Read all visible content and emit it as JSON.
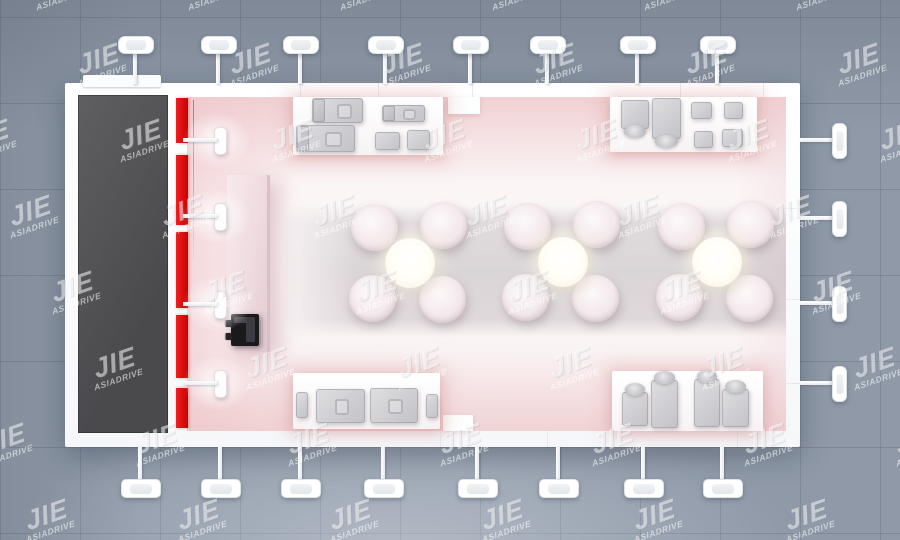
{
  "watermark": {
    "brand": "JIE",
    "subtext": "ASIADRIVE"
  },
  "palette": {
    "hall_floor": "#8f99a8",
    "booth_white": "#fafbfc",
    "platform_dark": "#4f4f51",
    "accent_red": "#e30b12",
    "interior_floor_pink": "#f9f0f1",
    "carpet_gray": "#cfc8ce",
    "equipment_gray": "#cdced2",
    "register_black": "#1a1a1d",
    "seat_pink_white": "#f6edf0",
    "table_center_cream": "#fffdf2"
  },
  "scene": {
    "platform_label": "dark display platform",
    "red_wall_label": "red accent wall",
    "reception_label": "reception counter",
    "register_label": "black counter machine",
    "counters": [
      "top-left service counter",
      "top-right service counter",
      "bottom-left service counter",
      "bottom-right service counter"
    ],
    "tables": {
      "clusters": 3,
      "seats_per_cluster": 4
    },
    "lights": {
      "top": 8,
      "bottom": 8,
      "right": 4,
      "interior_left": 4
    }
  }
}
